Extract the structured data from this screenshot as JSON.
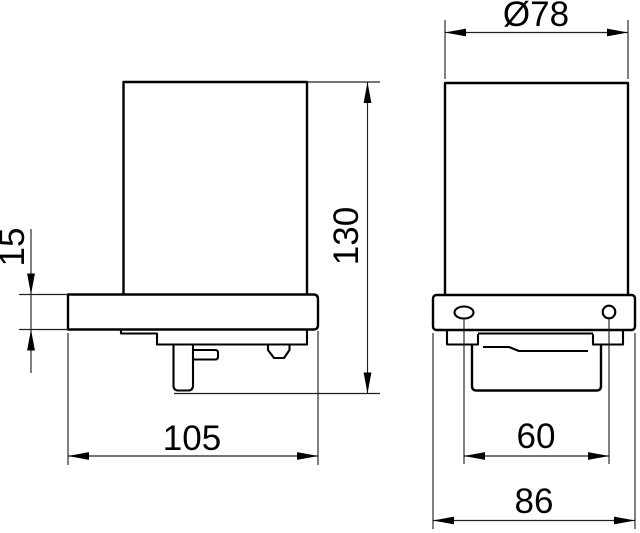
{
  "drawing": {
    "kind": "technical-dimension-drawing",
    "background_color": "#ffffff",
    "line_color": "#000000"
  },
  "dimensions": {
    "plate_thickness": "15",
    "overall_height": "130",
    "bracket_depth": "105",
    "glass_diameter": "Ø78",
    "hole_spacing": "60",
    "plate_width": "86"
  }
}
